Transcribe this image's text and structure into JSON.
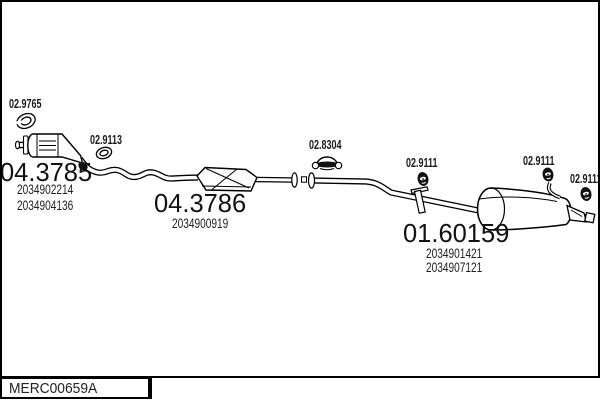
{
  "colors": {
    "background": "#ffffff",
    "line": "#000000",
    "text": "#1a1a1a"
  },
  "footer": {
    "drawing_code": "MERC00659A"
  },
  "icons": {
    "gasket": "open-ring",
    "ring": "o-ring",
    "clamp": "exhaust-clamp",
    "hanger": "rubber-mount"
  },
  "parts": {
    "gasket": {
      "code": "02.9765"
    },
    "ring": {
      "code": "02.9113"
    },
    "front_catalyst": {
      "code": "04.3785",
      "oem": [
        "2034902214",
        "2034904136"
      ]
    },
    "centre_silencer": {
      "code": "04.3786",
      "oem": [
        "2034900919"
      ]
    },
    "clamp": {
      "code": "02.8304"
    },
    "hanger_front": {
      "code": "02.9111"
    },
    "hanger_rear": {
      "code": "02.9111"
    },
    "hanger_tail": {
      "code": "02.9111"
    },
    "rear_silencer": {
      "code": "01.60159",
      "oem": [
        "2034901421",
        "2034907121"
      ]
    }
  }
}
